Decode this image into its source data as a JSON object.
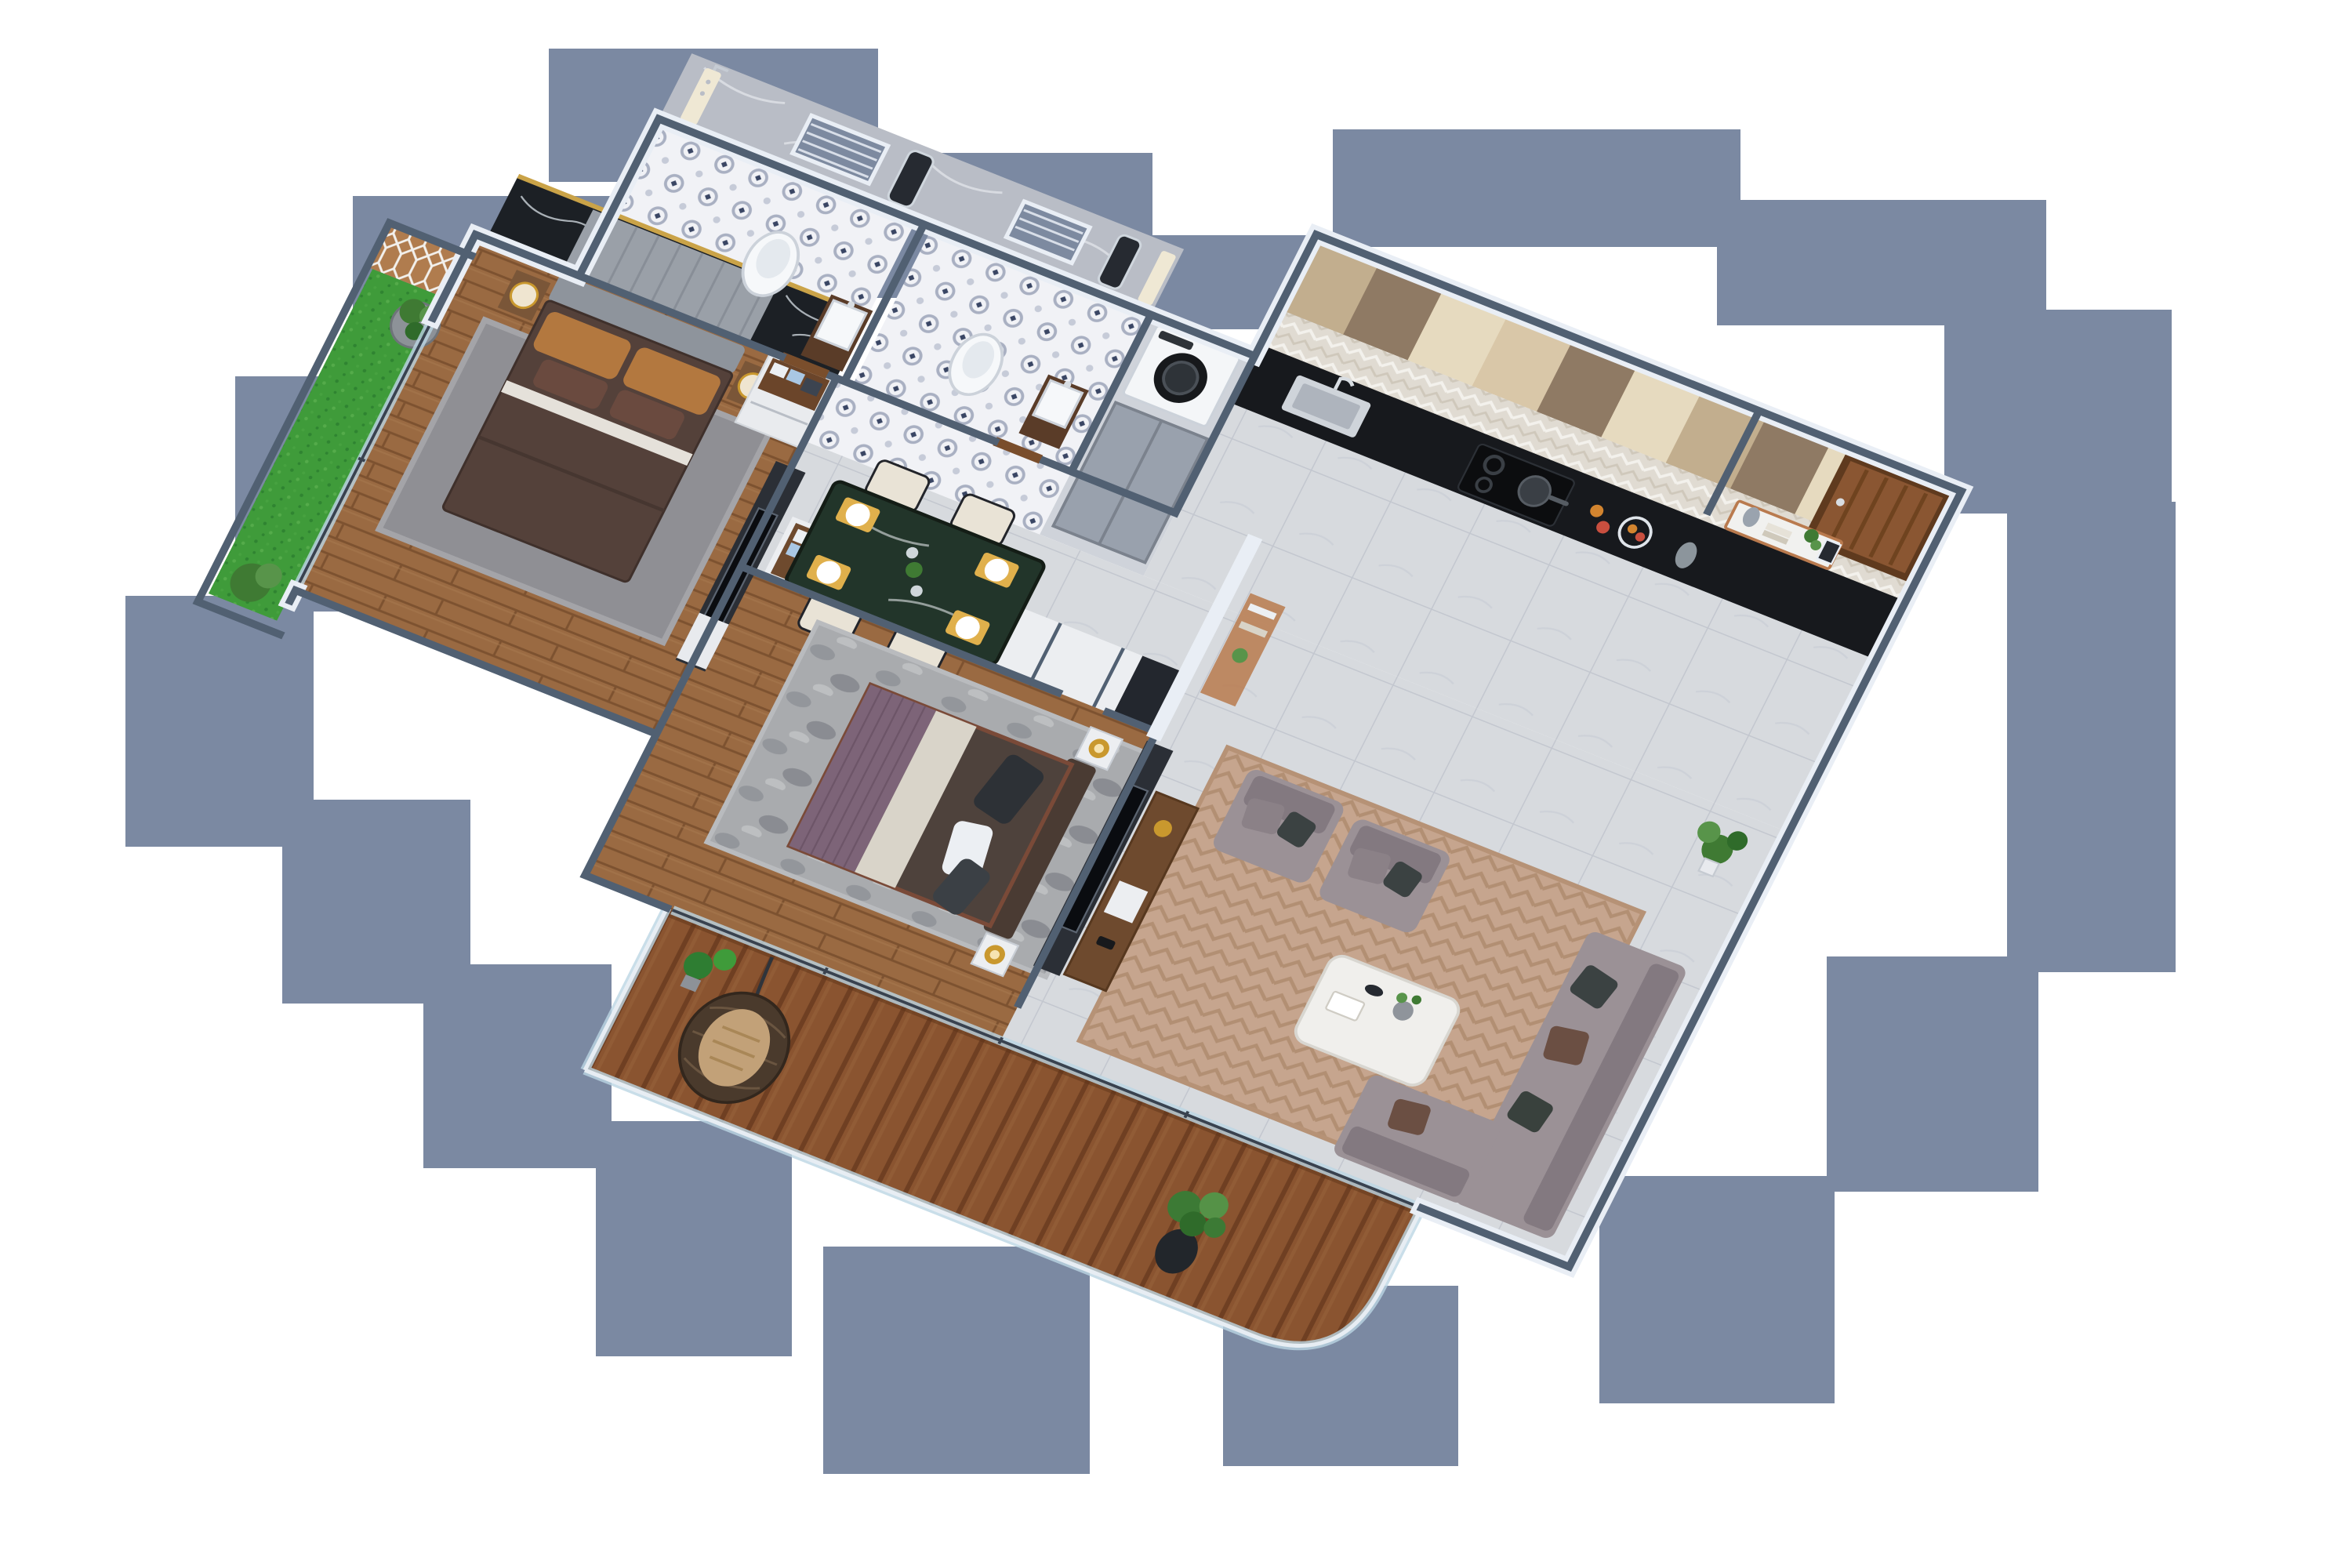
{
  "scene": {
    "kind": "3d-isometric-apartment-floor-plan-render",
    "background": "#ffffff",
    "shadow_color": "#7b89a2",
    "wall_face": "#e9eef5",
    "wall_top": "#516072"
  },
  "palette": {
    "bath_marble": "#b9bdc6",
    "bath_tile_base": "#f1f2f6",
    "bath_tile_motif": "#a9b0c2",
    "bath_tile_accent": "#3a4664",
    "louver": "#7d8aa0",
    "shower_panel": "#efe8d4",
    "vanity_wood": "#5a3c28",
    "porcelain": "#f6f8fa",
    "mirror": "#262a31",
    "wood_floor": "#9a6a42",
    "wood_floor_line": "#7d5230",
    "deck_plank_a": "#8a5430",
    "deck_plank_b": "#6f3f22",
    "turf": "#3f9b3a",
    "turf_dot": "#2f8431",
    "lattice_wood": "#b07c4e",
    "lattice_line": "#f2f0ec",
    "tile_gray": "#d7dade",
    "tile_line": "#c3c7cf",
    "cab_beige": "#d9c7a8",
    "cab_tan": "#c2ae8e",
    "cab_brown": "#8f7a64",
    "cab_cream": "#e6dabf",
    "backsplash": "#e0dbd2",
    "counter_black": "#17191d",
    "hob": "#0c0d0f",
    "door_wood": "#8a5632",
    "door_frame": "#5f3a1e",
    "dining_marble": "#22352a",
    "chair_cream": "#e9e3d6",
    "mat_yellow": "#e0b04c",
    "sofa_gray": "#9b9196",
    "sofa_dark": "#837980",
    "pillow_dark": "#3b4242",
    "pillow_brown": "#6b4f43",
    "rug_living": "#c6a58e",
    "rug_living_line": "#b28f73",
    "rug_gray": "#8f8f94",
    "rug_bed2": "#a9abae",
    "marble_black": "#1c2025",
    "headboard_gray": "#9aa0a8",
    "bed_duvet": "#54413a",
    "bed_sheet": "#e5e1da",
    "pillow_tan": "#b3783f",
    "bed2_purple": "#7d6478",
    "bed2_cream": "#d9d4c9",
    "bed2_brown": "#4e423c",
    "bed2_frame": "#7a4a38",
    "wardrobe_white": "#eceef1",
    "clothes_blue": "#a9c7e4",
    "walnut": "#6e4a2e",
    "gold": "#c9982e",
    "lamp_shade": "#efe5d0",
    "washer_body": "#f4f6f8",
    "washer_door": "#17191c",
    "fridge_gray": "#99a1ad",
    "coffee_table": "#f0efec",
    "plant_green": "#3f7a33",
    "plant_green_light": "#58944a",
    "planter_gray": "#8d9298",
    "egg_rattan": "#4a3a2c",
    "egg_cushion": "#c2a178",
    "glass_fill": "#cfe2ec"
  },
  "counts": {
    "bathrooms": 2,
    "bedrooms": 2,
    "balconies": 2,
    "dining_chairs": 4,
    "armchairs": 2
  },
  "rooms": [
    {
      "id": "master-bathroom",
      "label": "Master Bathroom",
      "features": [
        "gray marble walls",
        "louver window",
        "cream shower column",
        "wall-hung toilet",
        "dark-wood vanity with basin",
        "mirror",
        "blue patterned tile floor"
      ]
    },
    {
      "id": "second-bathroom",
      "label": "Bathroom 2",
      "features": [
        "gray marble walls",
        "louver window",
        "shower column",
        "wall-hung toilet",
        "vanity with basin",
        "mirror",
        "patterned tile floor"
      ]
    },
    {
      "id": "utility",
      "label": "Utility Nook",
      "features": [
        "front-load washing machine",
        "gray refrigerator"
      ]
    },
    {
      "id": "kitchen",
      "label": "Kitchen",
      "features": [
        "beige and brown cabinet wall",
        "chevron backsplash",
        "black granite counter",
        "sink with faucet",
        "gas hob with pan",
        "fruit bowl"
      ]
    },
    {
      "id": "entrance",
      "label": "Entrance",
      "features": [
        "wooden entry door",
        "copper console table",
        "vases and books",
        "potted plant"
      ]
    },
    {
      "id": "dining",
      "label": "Dining Area",
      "features": [
        "dark green marble table",
        "four cream chairs",
        "yellow place settings with white plates",
        "glassware"
      ]
    },
    {
      "id": "living",
      "label": "Living Room",
      "features": [
        "two gray armchairs",
        "gray corner sofa",
        "white marble coffee table",
        "beige chevron rug",
        "gray marble tile floor"
      ]
    },
    {
      "id": "master-bedroom",
      "label": "Master Bedroom",
      "features": [
        "upholstered headboard wall with black marble panels",
        "double bed with brown duvet and tan pillows",
        "nightstand lamps",
        "white-walnut dresser with towels",
        "TV partition",
        "gray rug",
        "wood floor"
      ]
    },
    {
      "id": "bedroom-2",
      "label": "Bedroom 2",
      "features": [
        "double bed with purple runner",
        "gold nightstand lamps",
        "white wardrobe with folded clothes",
        "dark TV partition",
        "walnut media console",
        "mottled gray rug",
        "wood floor"
      ]
    },
    {
      "id": "west-balcony",
      "label": "Garden Balcony",
      "features": [
        "artificial turf",
        "geometric wood lattice wall",
        "cylindrical planter",
        "shrub"
      ]
    },
    {
      "id": "south-balcony",
      "label": "Deck Balcony",
      "features": [
        "wooden deck",
        "hanging egg chair",
        "potted conifers",
        "tall potted tree",
        "curved glass railing with chrome handrail"
      ]
    }
  ]
}
